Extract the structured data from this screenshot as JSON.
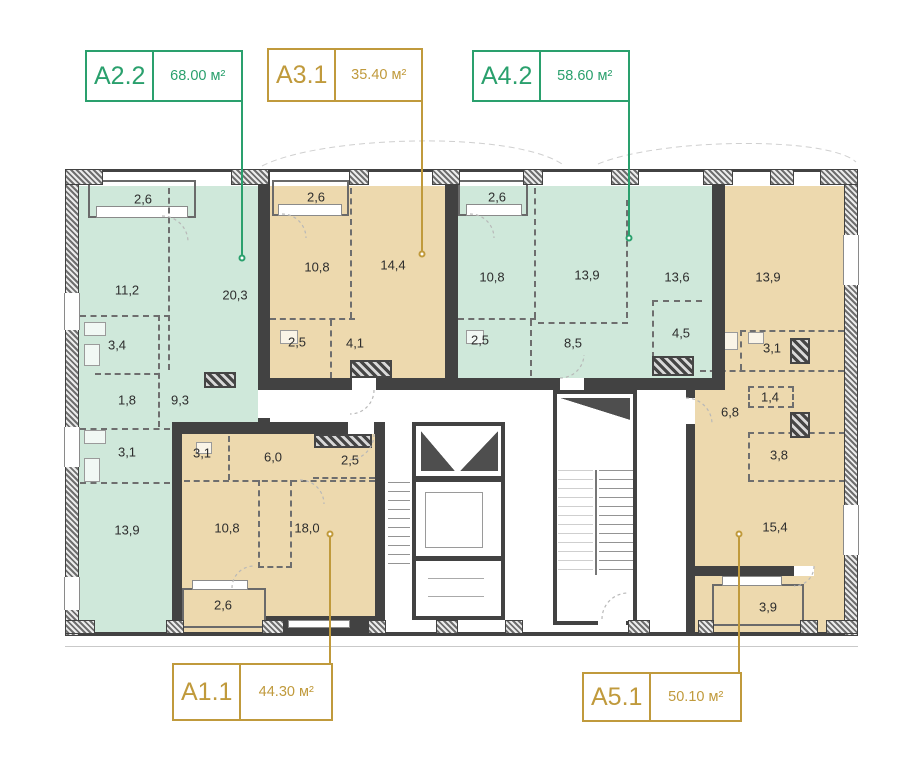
{
  "colors": {
    "green_accent": "#2aa06d",
    "gold_accent": "#c09a3c",
    "green_fill": "#cfe8da",
    "tan_fill": "#edd9ae"
  },
  "apartments": [
    {
      "unit": "A2.2",
      "area_label": "68.00 м²",
      "accent": "green",
      "rooms": [
        {
          "value": "2,6"
        },
        {
          "value": "11,2"
        },
        {
          "value": "20,3"
        },
        {
          "value": "3,4"
        },
        {
          "value": "1,8"
        },
        {
          "value": "9,3"
        },
        {
          "value": "3,1"
        },
        {
          "value": "13,9"
        }
      ]
    },
    {
      "unit": "A3.1",
      "area_label": "35.40 м²",
      "accent": "gold",
      "rooms": [
        {
          "value": "2,6"
        },
        {
          "value": "10,8"
        },
        {
          "value": "14,4"
        },
        {
          "value": "2,5"
        },
        {
          "value": "4,1"
        }
      ]
    },
    {
      "unit": "A4.2",
      "area_label": "58.60 м²",
      "accent": "green",
      "rooms": [
        {
          "value": "2,6"
        },
        {
          "value": "10,8"
        },
        {
          "value": "13,9"
        },
        {
          "value": "13,6"
        },
        {
          "value": "2,5"
        },
        {
          "value": "8,5"
        },
        {
          "value": "4,5"
        }
      ]
    },
    {
      "unit": "A1.1",
      "area_label": "44.30 м²",
      "accent": "gold",
      "rooms": [
        {
          "value": "3,1"
        },
        {
          "value": "6,0"
        },
        {
          "value": "2,5"
        },
        {
          "value": "10,8"
        },
        {
          "value": "18,0"
        },
        {
          "value": "2,6"
        }
      ]
    },
    {
      "unit": "A5.1",
      "area_label": "50.10 м²",
      "accent": "gold",
      "rooms": [
        {
          "value": "13,9"
        },
        {
          "value": "3,1"
        },
        {
          "value": "1,4"
        },
        {
          "value": "6,8"
        },
        {
          "value": "3,8"
        },
        {
          "value": "15,4"
        },
        {
          "value": "3,9"
        }
      ]
    }
  ]
}
